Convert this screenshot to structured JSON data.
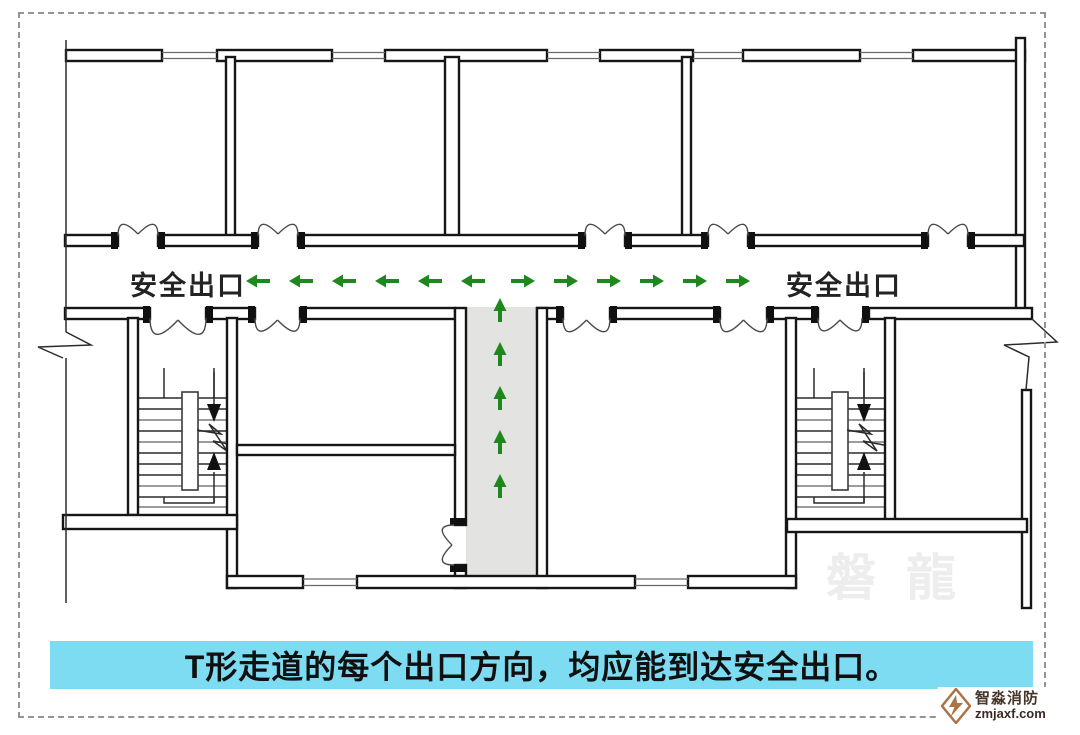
{
  "canvas": {
    "background": "#ffffff",
    "frame_color": "#949494"
  },
  "plan": {
    "wall_color": "#161616",
    "corridor_fill": "#e3e3e1",
    "exit_label_left": "安全出口",
    "exit_label_right": "安全出口",
    "label_color": "#232323",
    "arrows": {
      "color": "#1e871e",
      "left": {
        "y": 281,
        "xs": [
          258,
          301,
          344,
          387,
          430,
          473
        ]
      },
      "right": {
        "y": 281,
        "xs": [
          523,
          566,
          609,
          652,
          695,
          738
        ]
      },
      "up": {
        "x": 500,
        "ys": [
          310,
          354,
          398,
          442,
          486
        ]
      }
    },
    "doors": {
      "top_wall_swing_up": {
        "wall_y": 235,
        "openings": [
          [
            118,
            158
          ],
          [
            258,
            298
          ],
          [
            585,
            625
          ],
          [
            708,
            748
          ],
          [
            928,
            968
          ]
        ]
      },
      "bottom_wall_swing_down": {
        "wall_y": 308,
        "openings": [
          [
            150,
            206
          ],
          [
            255,
            300
          ],
          [
            563,
            610
          ],
          [
            720,
            767
          ],
          [
            818,
            862
          ]
        ]
      },
      "side_wall_swing_left": {
        "wall_x": 455,
        "openings": [
          [
            525,
            565
          ]
        ]
      }
    }
  },
  "caption": {
    "text": "T形走道的每个出口方向，均应能到达安全出口。",
    "bg": "#7edcf2",
    "color": "#101010"
  },
  "watermark": {
    "text": "磐龍",
    "color": "#ededed"
  },
  "logo": {
    "title": "智淼消防",
    "domain": "zmjaxf.com",
    "accent": "#aa7448",
    "title_color": "#463529",
    "domain_color": "#3a2a22"
  }
}
